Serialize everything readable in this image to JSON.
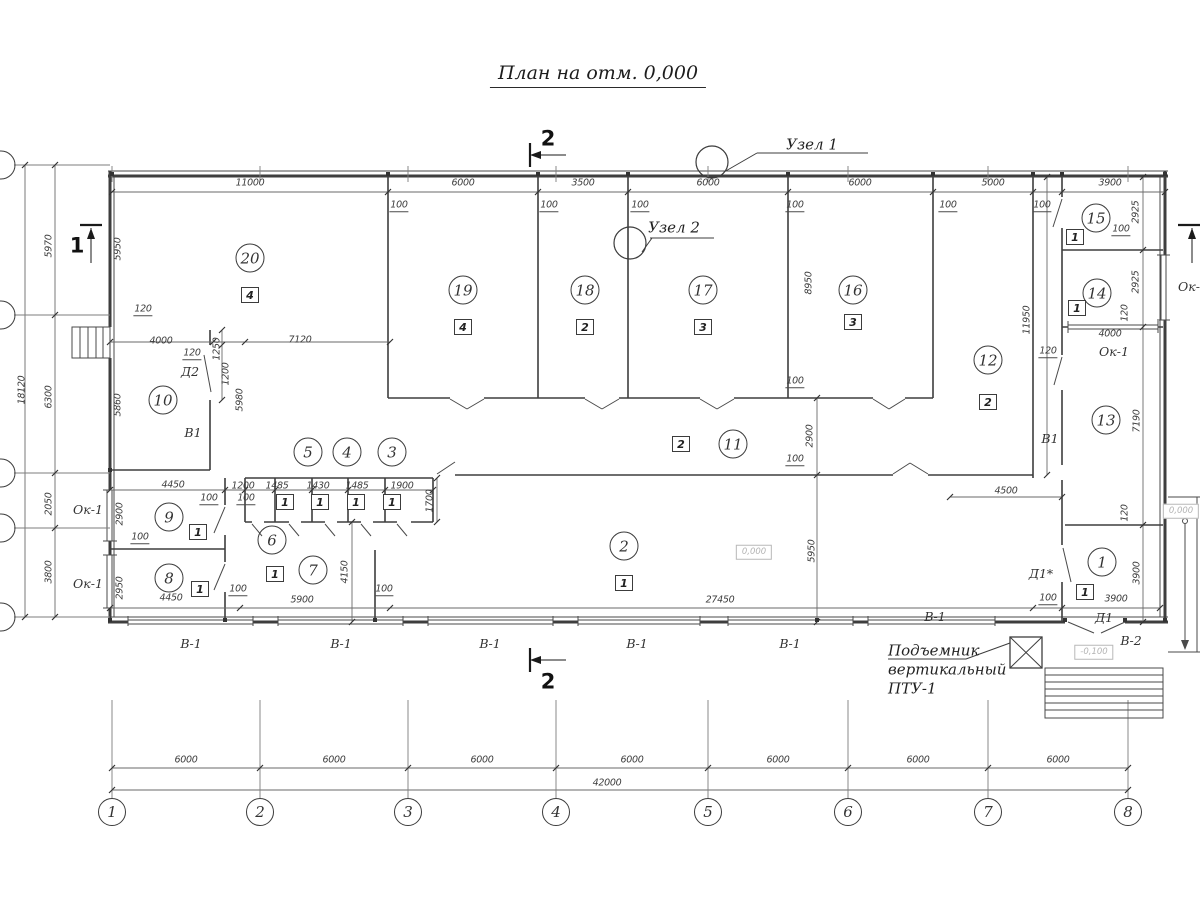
{
  "title": {
    "text": "План на отм. 0,000"
  },
  "sections": {
    "top": "2",
    "bottom": "2",
    "left": "1"
  },
  "nodes": {
    "node1": "Узел 1",
    "node2": "Узел 2"
  },
  "lift": {
    "line1": "Подъемник",
    "line2": "вертикальный",
    "line3": "ПТУ-1"
  },
  "colors": {
    "wall": "#3e3e3e",
    "thin": "#555555",
    "faint": "#b8b8b8"
  },
  "annotations": {
    "dimensions": [
      {
        "t": "11000",
        "x": 250,
        "y": 183
      },
      {
        "t": "6000",
        "x": 463,
        "y": 183
      },
      {
        "t": "3500",
        "x": 583,
        "y": 183
      },
      {
        "t": "6000",
        "x": 708,
        "y": 183
      },
      {
        "t": "6000",
        "x": 860,
        "y": 183
      },
      {
        "t": "5000",
        "x": 993,
        "y": 183
      },
      {
        "t": "3900",
        "x": 1110,
        "y": 183
      },
      {
        "t": "6000",
        "x": 186,
        "y": 760
      },
      {
        "t": "6000",
        "x": 334,
        "y": 760
      },
      {
        "t": "6000",
        "x": 482,
        "y": 760
      },
      {
        "t": "6000",
        "x": 632,
        "y": 760
      },
      {
        "t": "6000",
        "x": 778,
        "y": 760
      },
      {
        "t": "6000",
        "x": 918,
        "y": 760
      },
      {
        "t": "6000",
        "x": 1058,
        "y": 760
      },
      {
        "t": "42000",
        "x": 607,
        "y": 783
      },
      {
        "t": "5970",
        "x": 49,
        "y": 246,
        "rot": 1
      },
      {
        "t": "6300",
        "x": 49,
        "y": 397,
        "rot": 1
      },
      {
        "t": "2050",
        "x": 49,
        "y": 504,
        "rot": 1
      },
      {
        "t": "3800",
        "x": 49,
        "y": 572,
        "rot": 1
      },
      {
        "t": "18120",
        "x": 22,
        "y": 390,
        "rot": 1
      },
      {
        "t": "5950",
        "x": 118,
        "y": 249,
        "rot": 1
      },
      {
        "t": "5860",
        "x": 118,
        "y": 405,
        "rot": 1
      },
      {
        "t": "2900",
        "x": 120,
        "y": 514,
        "rot": 1
      },
      {
        "t": "2950",
        "x": 120,
        "y": 588,
        "rot": 1
      },
      {
        "t": "4000",
        "x": 161,
        "y": 341
      },
      {
        "t": "7120",
        "x": 300,
        "y": 340
      },
      {
        "t": "1250",
        "x": 217,
        "y": 349,
        "rot": 1
      },
      {
        "t": "1200",
        "x": 226,
        "y": 374,
        "rot": 1
      },
      {
        "t": "5980",
        "x": 240,
        "y": 400,
        "rot": 1
      },
      {
        "t": "4450",
        "x": 173,
        "y": 485
      },
      {
        "t": "1200",
        "x": 243,
        "y": 486
      },
      {
        "t": "1485",
        "x": 277,
        "y": 486
      },
      {
        "t": "1430",
        "x": 318,
        "y": 486
      },
      {
        "t": "1485",
        "x": 357,
        "y": 486
      },
      {
        "t": "1900",
        "x": 402,
        "y": 486
      },
      {
        "t": "1700",
        "x": 430,
        "y": 501,
        "rot": 1
      },
      {
        "t": "4450",
        "x": 171,
        "y": 598
      },
      {
        "t": "4150",
        "x": 345,
        "y": 572,
        "rot": 1
      },
      {
        "t": "5900",
        "x": 302,
        "y": 600
      },
      {
        "t": "27450",
        "x": 720,
        "y": 600
      },
      {
        "t": "5950",
        "x": 812,
        "y": 551,
        "rot": 1
      },
      {
        "t": "2900",
        "x": 810,
        "y": 436,
        "rot": 1
      },
      {
        "t": "8950",
        "x": 809,
        "y": 283,
        "rot": 1
      },
      {
        "t": "4500",
        "x": 1006,
        "y": 491
      },
      {
        "t": "11950",
        "x": 1027,
        "y": 320,
        "rot": 1
      },
      {
        "t": "2925",
        "x": 1136,
        "y": 212,
        "rot": 1
      },
      {
        "t": "2925",
        "x": 1136,
        "y": 282,
        "rot": 1
      },
      {
        "t": "120",
        "x": 1125,
        "y": 313,
        "rot": 1
      },
      {
        "t": "4000",
        "x": 1110,
        "y": 334
      },
      {
        "t": "7190",
        "x": 1137,
        "y": 421,
        "rot": 1
      },
      {
        "t": "120",
        "x": 1125,
        "y": 513,
        "rot": 1
      },
      {
        "t": "3900",
        "x": 1137,
        "y": 573,
        "rot": 1
      },
      {
        "t": "3900",
        "x": 1116,
        "y": 599
      }
    ],
    "callouts": [
      {
        "t": "100",
        "x": 399,
        "y": 206
      },
      {
        "t": "100",
        "x": 549,
        "y": 206
      },
      {
        "t": "100",
        "x": 640,
        "y": 206
      },
      {
        "t": "100",
        "x": 795,
        "y": 206
      },
      {
        "t": "100",
        "x": 948,
        "y": 206
      },
      {
        "t": "100",
        "x": 1042,
        "y": 206
      },
      {
        "t": "120",
        "x": 143,
        "y": 310
      },
      {
        "t": "120",
        "x": 192,
        "y": 354
      },
      {
        "t": "100",
        "x": 209,
        "y": 499
      },
      {
        "t": "100",
        "x": 246,
        "y": 499
      },
      {
        "t": "100",
        "x": 140,
        "y": 538
      },
      {
        "t": "100",
        "x": 238,
        "y": 590
      },
      {
        "t": "100",
        "x": 384,
        "y": 590
      },
      {
        "t": "100",
        "x": 795,
        "y": 460
      },
      {
        "t": "100",
        "x": 795,
        "y": 382
      },
      {
        "t": "120",
        "x": 1048,
        "y": 352
      },
      {
        "t": "100",
        "x": 1121,
        "y": 230
      },
      {
        "t": "100",
        "x": 1048,
        "y": 599
      }
    ],
    "tags": [
      {
        "t": "Д2",
        "x": 190,
        "y": 372
      },
      {
        "t": "В1",
        "x": 193,
        "y": 433
      },
      {
        "t": "В1",
        "x": 1050,
        "y": 439
      },
      {
        "t": "Ок-1",
        "x": 88,
        "y": 510
      },
      {
        "t": "Ок-1",
        "x": 88,
        "y": 584
      },
      {
        "t": "Ок-1",
        "x": 1114,
        "y": 352
      },
      {
        "t": "Ок-1",
        "x": 1193,
        "y": 287
      },
      {
        "t": "В-1",
        "x": 191,
        "y": 644
      },
      {
        "t": "В-1",
        "x": 341,
        "y": 644
      },
      {
        "t": "В-1",
        "x": 490,
        "y": 644
      },
      {
        "t": "В-1",
        "x": 637,
        "y": 644
      },
      {
        "t": "В-1",
        "x": 790,
        "y": 644
      },
      {
        "t": "В-1",
        "x": 935,
        "y": 617
      },
      {
        "t": "Д1*",
        "x": 1041,
        "y": 574
      },
      {
        "t": "Д1",
        "x": 1104,
        "y": 618
      },
      {
        "t": "В-2",
        "x": 1131,
        "y": 641
      }
    ],
    "rooms": [
      {
        "t": "20",
        "x": 250,
        "y": 258
      },
      {
        "t": "19",
        "x": 463,
        "y": 290
      },
      {
        "t": "18",
        "x": 585,
        "y": 290
      },
      {
        "t": "17",
        "x": 703,
        "y": 290
      },
      {
        "t": "16",
        "x": 853,
        "y": 290
      },
      {
        "t": "15",
        "x": 1096,
        "y": 218
      },
      {
        "t": "14",
        "x": 1097,
        "y": 293
      },
      {
        "t": "13",
        "x": 1106,
        "y": 420
      },
      {
        "t": "12",
        "x": 988,
        "y": 360
      },
      {
        "t": "11",
        "x": 733,
        "y": 444
      },
      {
        "t": "10",
        "x": 163,
        "y": 400
      },
      {
        "t": "9",
        "x": 169,
        "y": 517
      },
      {
        "t": "8",
        "x": 169,
        "y": 578
      },
      {
        "t": "7",
        "x": 313,
        "y": 570
      },
      {
        "t": "6",
        "x": 272,
        "y": 540
      },
      {
        "t": "5",
        "x": 308,
        "y": 452
      },
      {
        "t": "4",
        "x": 347,
        "y": 452
      },
      {
        "t": "3",
        "x": 392,
        "y": 452
      },
      {
        "t": "2",
        "x": 624,
        "y": 546
      },
      {
        "t": "1",
        "x": 1102,
        "y": 562
      }
    ],
    "boxes": [
      {
        "t": "4",
        "x": 250,
        "y": 295
      },
      {
        "t": "4",
        "x": 463,
        "y": 327
      },
      {
        "t": "2",
        "x": 585,
        "y": 327
      },
      {
        "t": "3",
        "x": 703,
        "y": 327
      },
      {
        "t": "3",
        "x": 853,
        "y": 322
      },
      {
        "t": "1",
        "x": 1075,
        "y": 237
      },
      {
        "t": "1",
        "x": 1077,
        "y": 308
      },
      {
        "t": "2",
        "x": 988,
        "y": 402
      },
      {
        "t": "2",
        "x": 681,
        "y": 444
      },
      {
        "t": "1",
        "x": 624,
        "y": 583
      },
      {
        "t": "1",
        "x": 198,
        "y": 532
      },
      {
        "t": "1",
        "x": 200,
        "y": 589
      },
      {
        "t": "1",
        "x": 275,
        "y": 574
      },
      {
        "t": "1",
        "x": 285,
        "y": 502
      },
      {
        "t": "1",
        "x": 320,
        "y": 502
      },
      {
        "t": "1",
        "x": 356,
        "y": 502
      },
      {
        "t": "1",
        "x": 392,
        "y": 502
      },
      {
        "t": "1",
        "x": 1085,
        "y": 592
      }
    ],
    "axes": [
      {
        "t": "1",
        "x": 112,
        "y": 812
      },
      {
        "t": "2",
        "x": 260,
        "y": 812
      },
      {
        "t": "3",
        "x": 408,
        "y": 812
      },
      {
        "t": "4",
        "x": 556,
        "y": 812
      },
      {
        "t": "5",
        "x": 708,
        "y": 812
      },
      {
        "t": "6",
        "x": 848,
        "y": 812
      },
      {
        "t": "7",
        "x": 988,
        "y": 812
      },
      {
        "t": "8",
        "x": 1128,
        "y": 812
      }
    ],
    "elevations": [
      {
        "t": "0,000",
        "x": 754,
        "y": 552
      },
      {
        "t": "-0,100",
        "x": 1094,
        "y": 652
      },
      {
        "t": "0,000",
        "x": 1181,
        "y": 511
      }
    ]
  }
}
